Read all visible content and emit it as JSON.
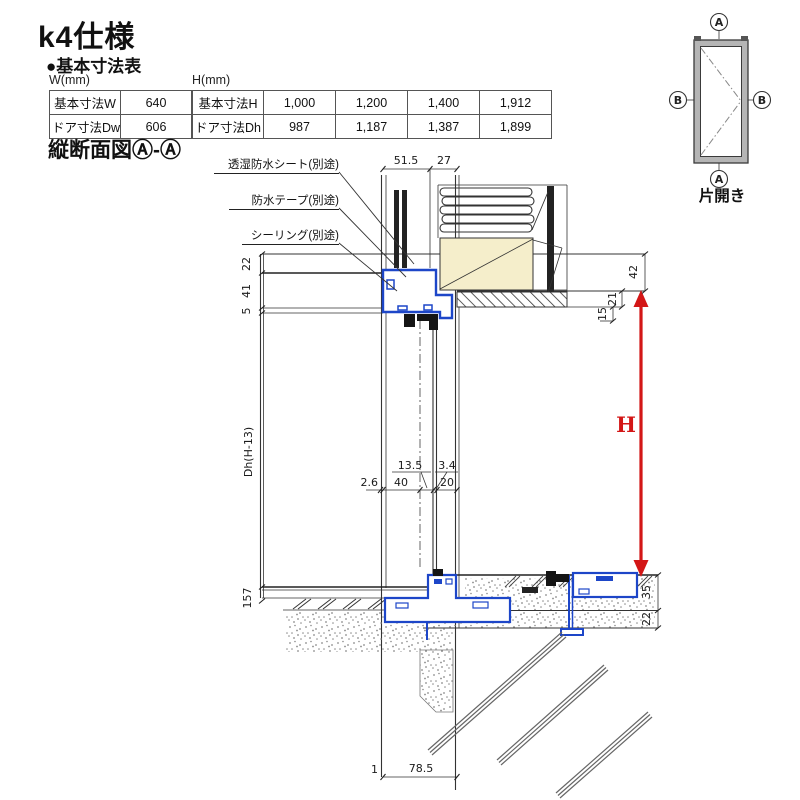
{
  "title": "k4仕様",
  "subtitle": "●基本寸法表",
  "section_title": "縦断面図Ⓐ-Ⓐ",
  "tables": {
    "w": {
      "caption": "W(mm)",
      "rows": [
        [
          "基本寸法W",
          "640"
        ],
        [
          "ドア寸法Dw",
          "606"
        ]
      ]
    },
    "h": {
      "caption": "H(mm)",
      "rows": [
        [
          "基本寸法H",
          "1,000",
          "1,200",
          "1,400",
          "1,912"
        ],
        [
          "ドア寸法Dh",
          "987",
          "1,187",
          "1,387",
          "1,899"
        ]
      ]
    }
  },
  "callouts": [
    "透湿防水シート(別途)",
    "防水テープ(別途)",
    "シーリング(別途)"
  ],
  "dims": {
    "top": [
      "51.5",
      "27"
    ],
    "left": [
      "22",
      "41",
      "5"
    ],
    "right": [
      "42",
      "21",
      "15"
    ],
    "mid": [
      "2.6",
      "40",
      "13.5",
      "3.4",
      "20"
    ],
    "door_height": "Dh(H-13)",
    "h": "H",
    "floor_left": "157",
    "bottom_right": [
      "35",
      "22"
    ],
    "bottom": [
      "1",
      "78.5"
    ]
  },
  "elevation": {
    "marker_a": "A",
    "marker_b": "B",
    "caption": "片開き"
  },
  "colors": {
    "frame_blue": "#1d46c8",
    "arrow_red": "#d31616",
    "wood_beige": "#f5eecb",
    "concrete_dot": "#8a8a8a"
  }
}
